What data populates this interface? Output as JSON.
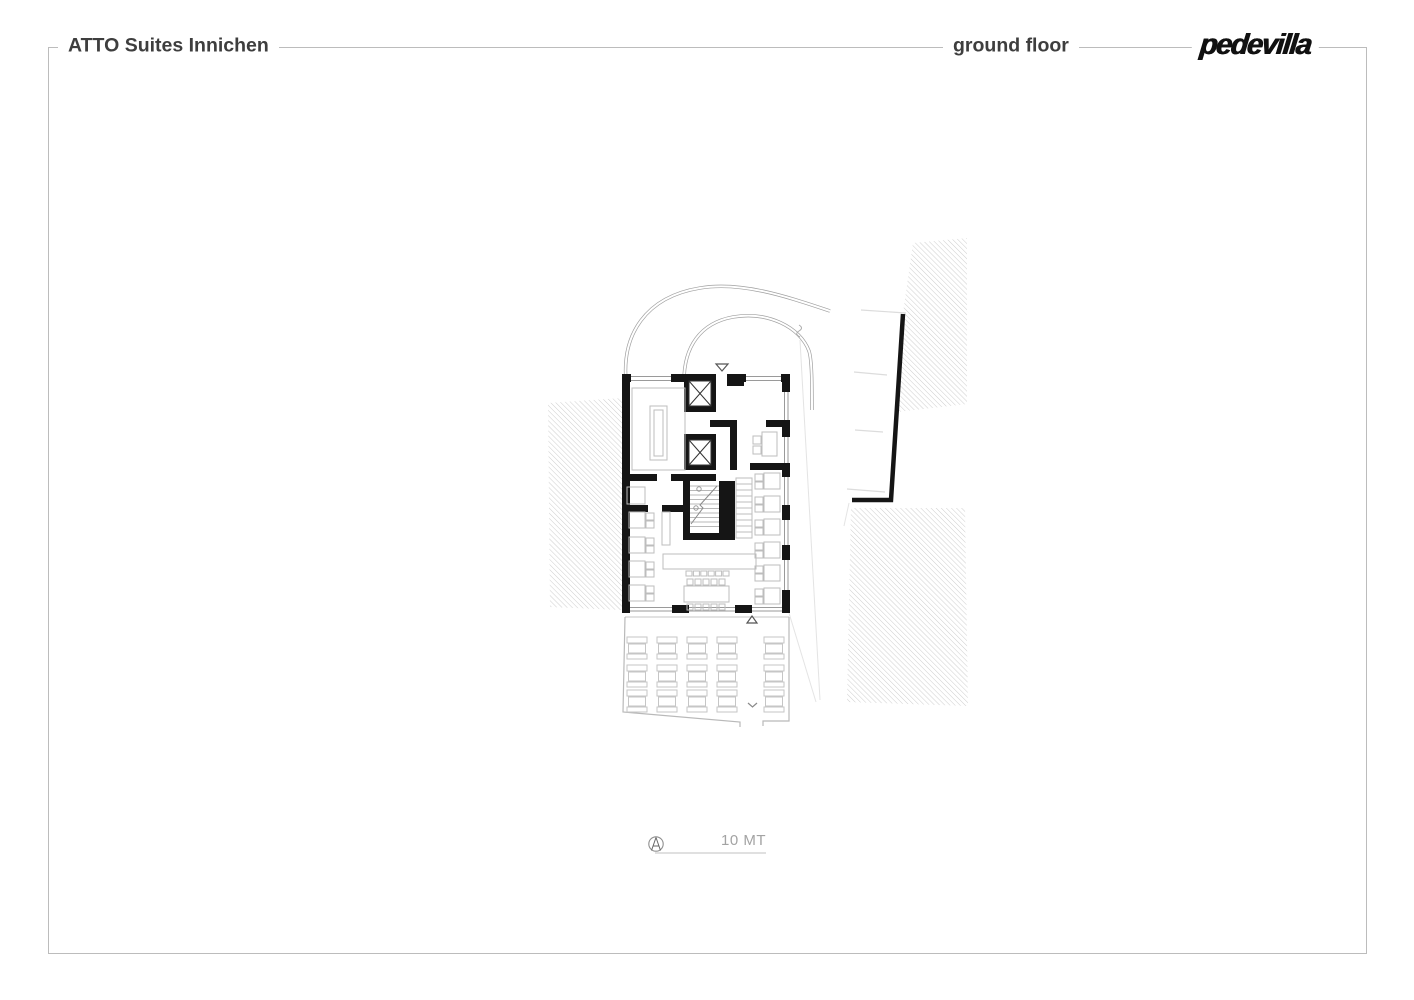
{
  "header": {
    "project_title": "ATTO Suites Innichen",
    "sheet_label": "ground floor",
    "logo_text": "pedevilla"
  },
  "scale_bar": {
    "label": "10 MT"
  },
  "icons": {
    "north_arrow": "north-arrow-icon",
    "entrance_marker": "triangle-down-marker",
    "terrace_marker": "triangle-up-marker",
    "terrace_exit_marker": "chevron-down-marker"
  },
  "plan": {
    "drawing_type": "architectural floor plan",
    "elements": [
      "site-hatch-left",
      "site-hatch-upper-right",
      "site-hatch-lower-right",
      "access-road",
      "driveway",
      "retaining-wall",
      "building-walls",
      "elevator-shafts",
      "staircase",
      "kitchen-island",
      "reception-desk",
      "dining-tables",
      "bar-counter",
      "banquette-bench",
      "terrace-table-grid"
    ]
  },
  "colors": {
    "background": "#ffffff",
    "frame": "#bcbcbc",
    "title_text": "#3e3e3e",
    "logo": "#111111",
    "walls": "#151515",
    "furniture": "#bdbdbd",
    "hatch": "#cdcdcd",
    "roads": "#9f9f9f",
    "scale_text": "#a3a3a3"
  }
}
